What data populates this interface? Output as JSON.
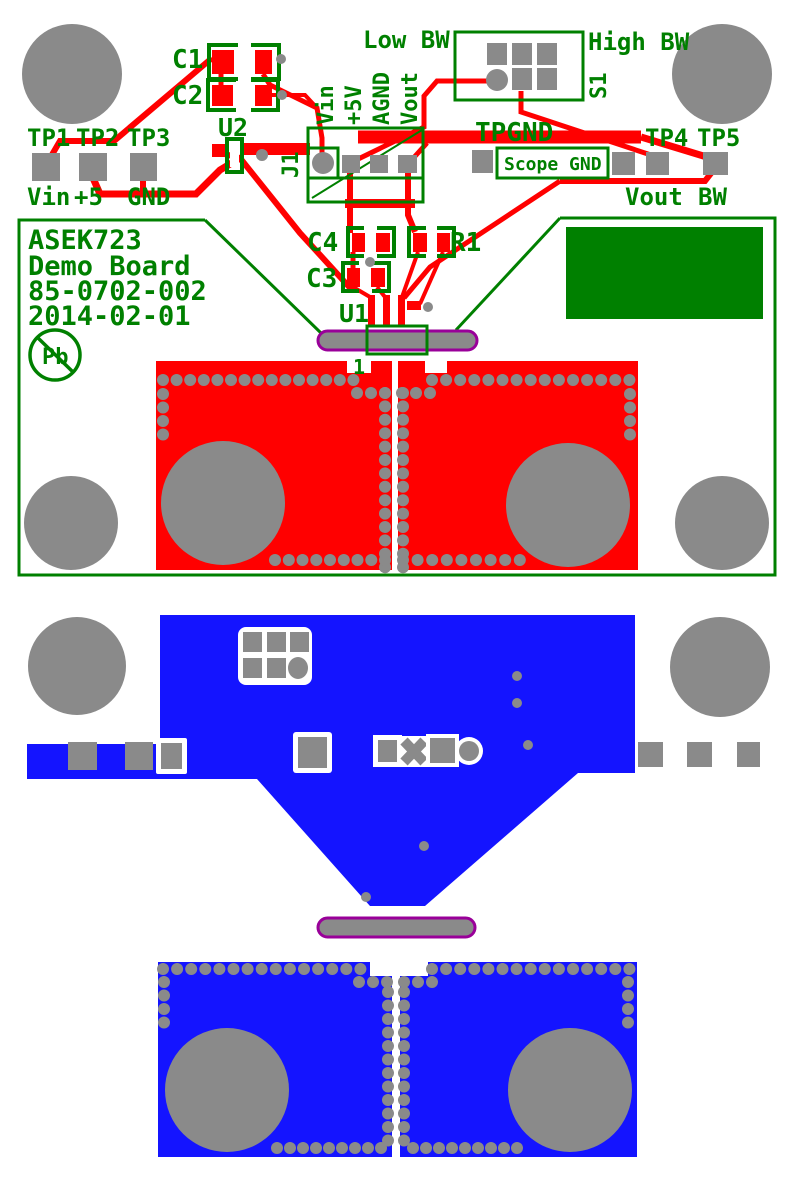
{
  "title": "ASEK723 Demo Board PCB layout",
  "colors": {
    "green": "#008000",
    "red": "#ff0000",
    "blue": "#1414ff",
    "gray": "#8a8a8a",
    "purple": "#990099",
    "bg": "#ffffff"
  },
  "top_board": {
    "testpoints": {
      "tp1": "TP1",
      "tp2": "TP2",
      "tp3": "TP3",
      "tp4": "TP4",
      "tp5": "TP5"
    },
    "net_labels": {
      "vin": "Vin",
      "plus5": "+5",
      "gnd": "GND",
      "vout": "Vout",
      "bw": "BW"
    },
    "refdes": {
      "c1": "C1",
      "c2": "C2",
      "c3": "C3",
      "c4": "C4",
      "r1": "R1",
      "u1": "U1",
      "u2": "U2",
      "j1": "J1",
      "s1": "S1"
    },
    "connector_pins": {
      "pin1": "Vin",
      "pin2": "+5V",
      "pin3": "AGND",
      "pin4": "Vout"
    },
    "switch_labels": {
      "low": "Low BW",
      "high": "High BW"
    },
    "ground_labels": {
      "tpgnd": "TPGND",
      "scope_gnd": "Scope GND"
    },
    "pin1_marker": "1",
    "title_block": {
      "line1": "ASEK723",
      "line2": "Demo Board",
      "line3": "85-0702-002",
      "line4": "2014-02-01",
      "lead_free": "Pb"
    }
  }
}
